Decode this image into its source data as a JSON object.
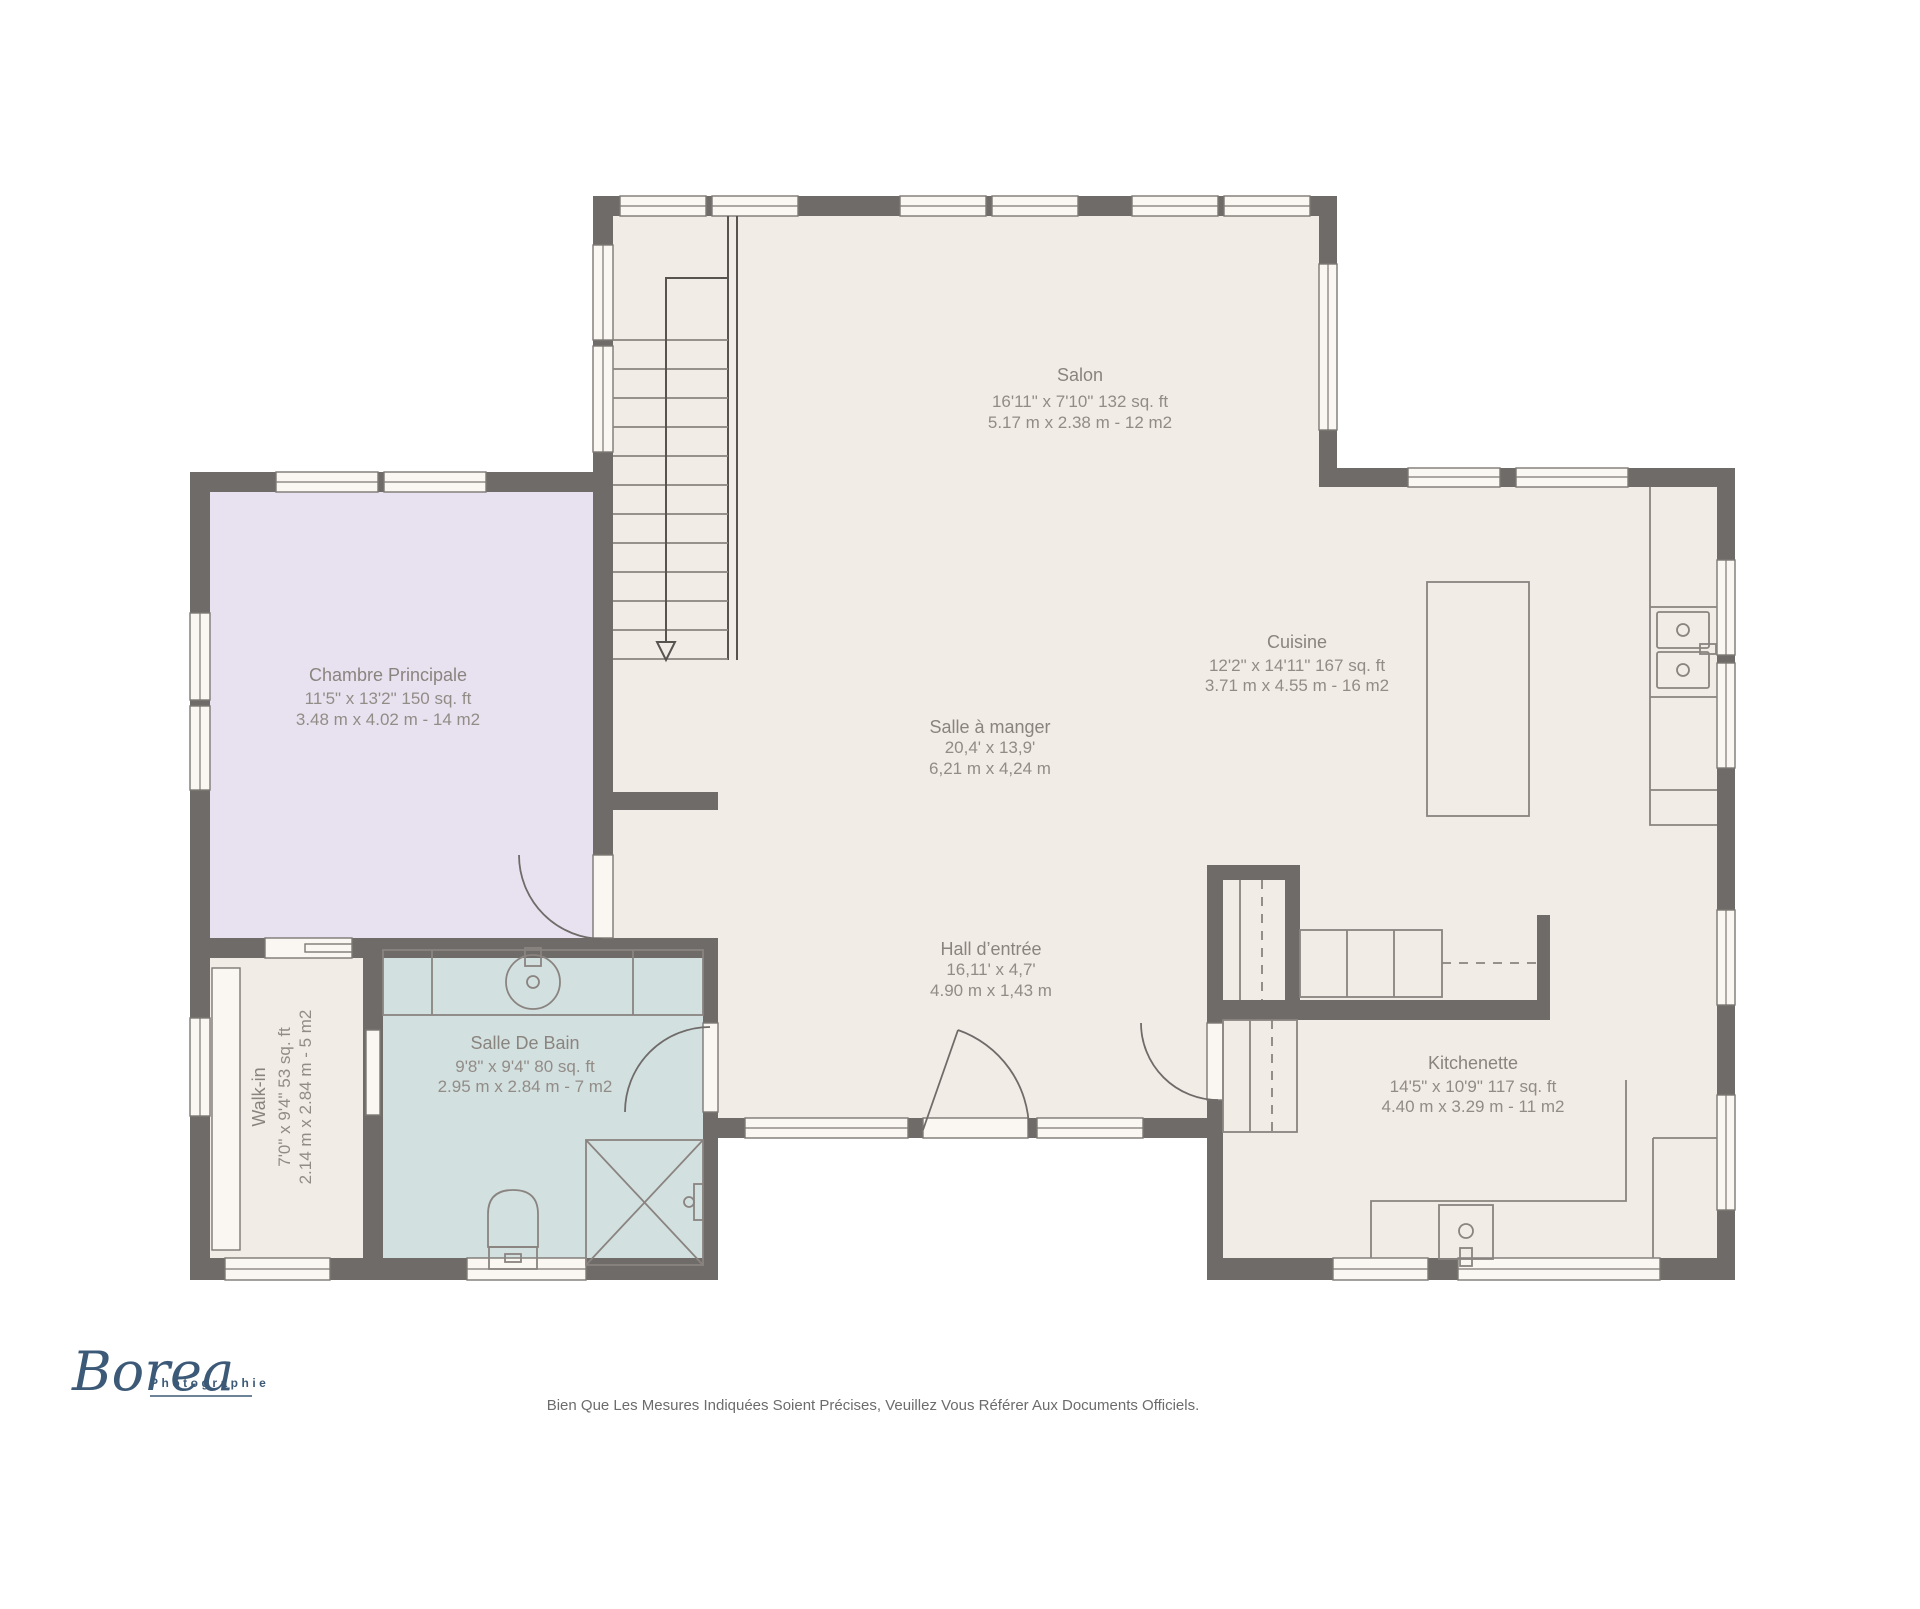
{
  "rooms": {
    "salon": {
      "name": "Salon",
      "imperial": "16'11\" x 7'10\" 132 sq. ft",
      "metric": "5.17 m x 2.38 m - 12 m2"
    },
    "chambre": {
      "name": "Chambre Principale",
      "imperial": "11'5\" x 13'2\" 150 sq. ft",
      "metric": "3.48 m x 4.02 m - 14 m2"
    },
    "cuisine": {
      "name": "Cuisine",
      "imperial": "12'2\" x 14'11\" 167 sq. ft",
      "metric": "3.71 m x 4.55 m - 16 m2"
    },
    "salle_a_manger": {
      "name": "Salle à manger",
      "imperial": "20,4' x 13,9'",
      "metric": "6,21 m x 4,24 m"
    },
    "hall": {
      "name": "Hall d’entrée",
      "imperial": "16,11' x 4,7'",
      "metric": "4.90 m x 1,43 m"
    },
    "kitchenette": {
      "name": "Kitchenette",
      "imperial": "14'5\" x 10'9\" 117 sq. ft",
      "metric": "4.40 m x 3.29 m - 11 m2"
    },
    "salle_de_bain": {
      "name": "Salle De Bain",
      "imperial": "9'8\" x 9'4\" 80 sq. ft",
      "metric": "2.95 m x 2.84 m - 7 m2"
    },
    "walkin": {
      "name": "Walk-in",
      "imperial": "7'0\" x 9'4\" 53 sq. ft",
      "metric": "2.14 m x 2.84 m - 5 m2"
    }
  },
  "logo": {
    "brand": "Borea",
    "tagline": "Photographie"
  },
  "footer": {
    "disclaimer": "Bien Que Les Mesures Indiquées Soient Précises, Veuillez Vous Référer Aux Documents Officiels."
  },
  "colors": {
    "background": "#ffffff",
    "floor": "#f2ece6",
    "bedroom": "#e8e2f0",
    "bathroom": "#d3e0e0",
    "wall": "#6f6b69",
    "window": "#faf6f2",
    "fixture_line": "#8a8480",
    "label_text": "#8a847f",
    "logo_blue": "#3c5a77",
    "disclaimer_text": "#6c6c6c"
  }
}
